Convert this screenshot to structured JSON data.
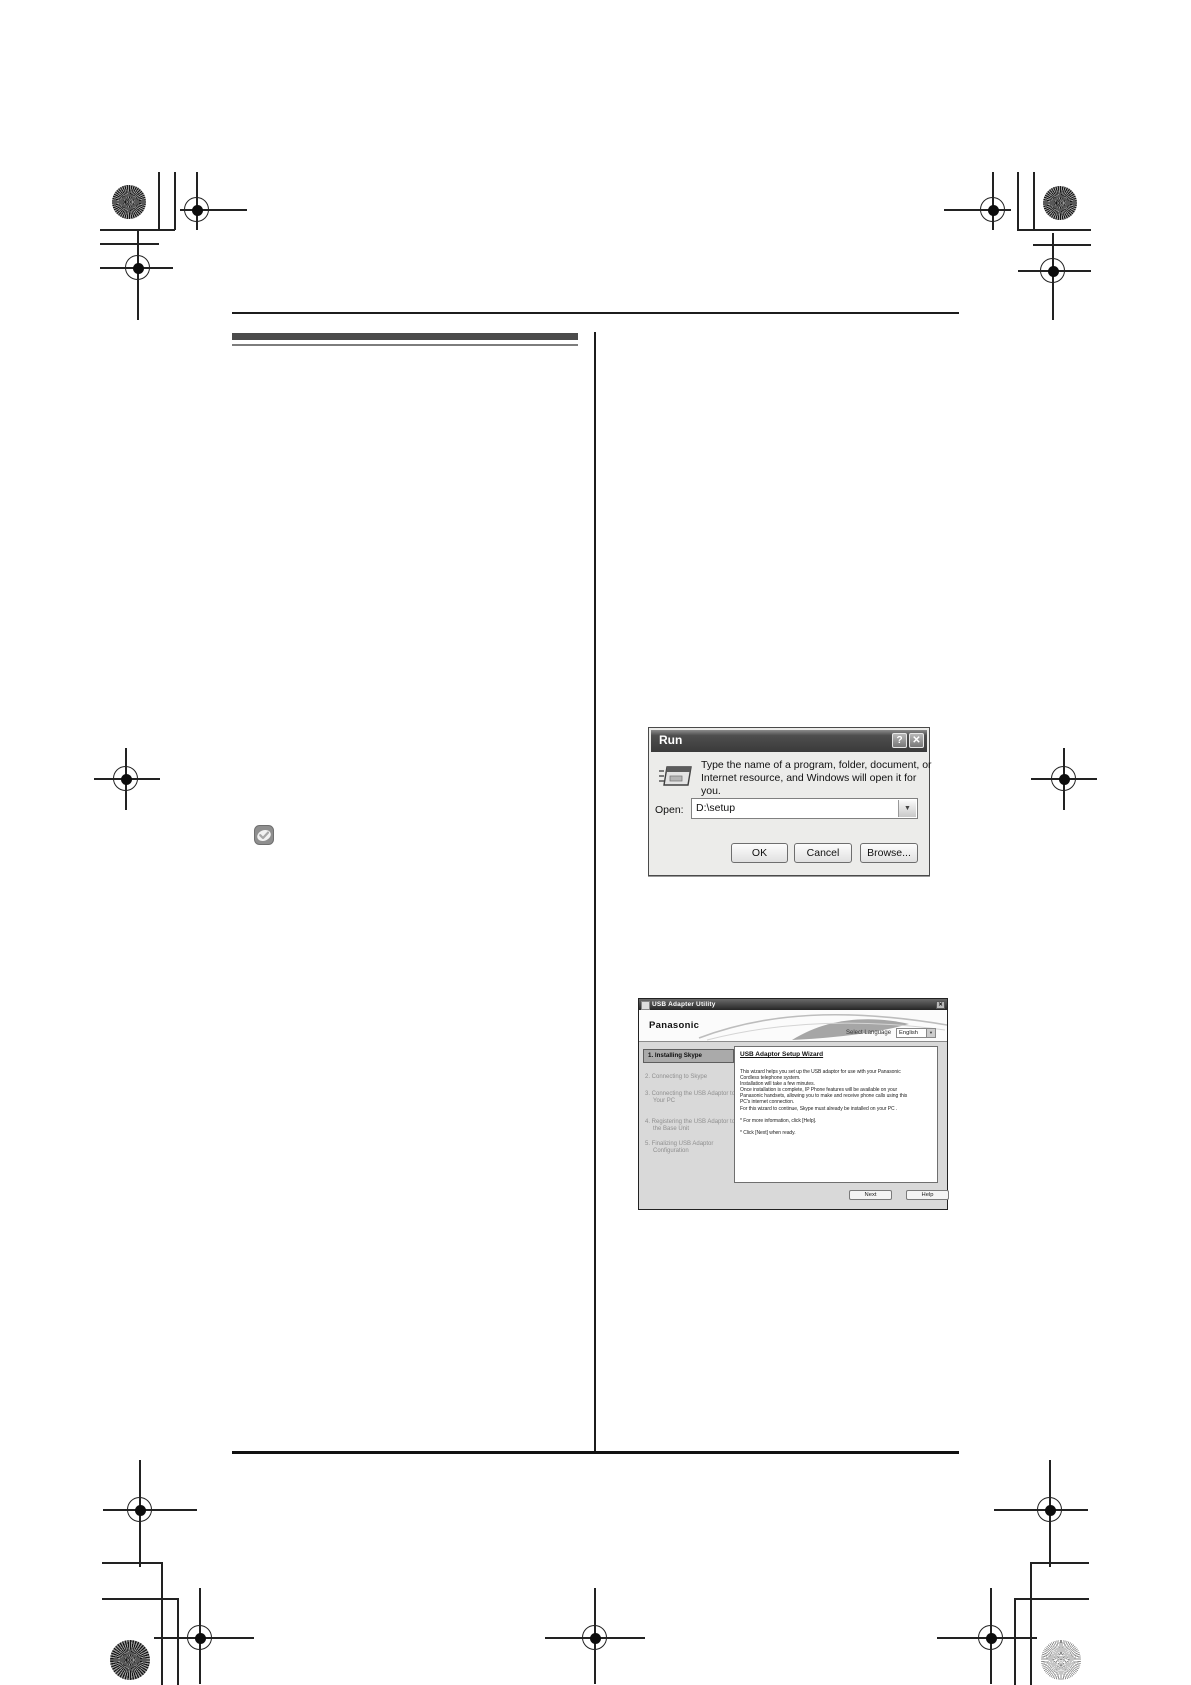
{
  "run_dialog": {
    "title": "Run",
    "help_button": "?",
    "close_button": "✕",
    "prompt": "Type the name of a program, folder, document, or Internet resource, and Windows will open it for you.",
    "open_label": "Open:",
    "open_value": "D:\\setup",
    "dropdown_arrow": "▼",
    "buttons": {
      "ok": "OK",
      "cancel": "Cancel",
      "browse": "Browse..."
    }
  },
  "usb_window": {
    "title": "USB Adapter Utility",
    "close_button": "✕",
    "brand": "Panasonic",
    "select_language_label": "Select Language",
    "language_value": "English",
    "dropdown_arrow": "▼",
    "steps": [
      "1. Installing Skype",
      "2. Connecting to Skype",
      "3. Connecting the USB Adaptor to Your PC",
      "4. Registering the USB Adaptor to the Base Unit",
      "5. Finalizing USB Adaptor Configuration"
    ],
    "wizard": {
      "heading": "USB Adaptor Setup Wizard",
      "lines": [
        "This wizard helps you set up the USB adaptor for use with your Panasonic",
        "Cordless telephone system.",
        "Installation will take a few minutes.",
        "Once installation is complete, IP Phone features will be available on your",
        "Panasonic handsets, allowing you to make and receive phone calls using this",
        "PC's internet connection.",
        "For this wizard to continue, Skype must already be installed on your PC .",
        "",
        "* For more information, click [Help].",
        "",
        "* Click [Next] when ready."
      ]
    },
    "buttons": {
      "next": "Next",
      "help": "Help"
    }
  },
  "icons": {
    "skype": "skype-check-icon",
    "run": "run-program-icon",
    "dropdown": "chevron-down-icon"
  }
}
